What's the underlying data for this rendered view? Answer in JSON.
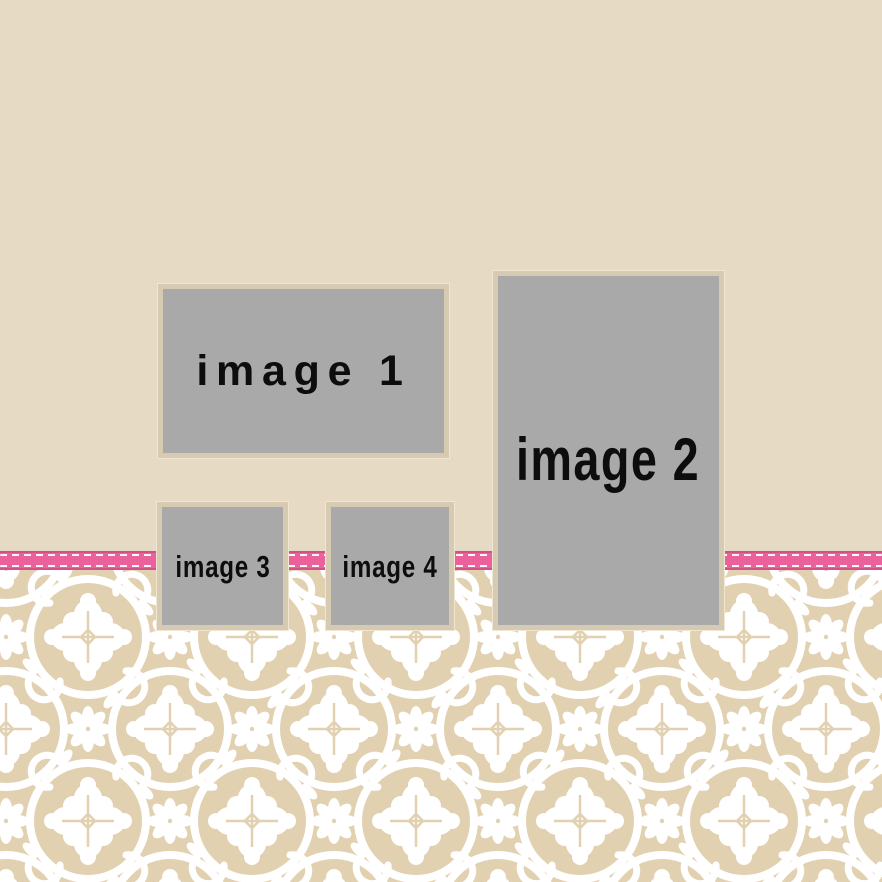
{
  "template": {
    "name": "scrapbook photo collage template",
    "placeholders": [
      {
        "id": "image-1",
        "label": "image 1"
      },
      {
        "id": "image-2",
        "label": "image 2"
      },
      {
        "id": "image-3",
        "label": "image 3"
      },
      {
        "id": "image-4",
        "label": "image 4"
      }
    ]
  },
  "decorations": {
    "ribbon": "stitched pink ribbon",
    "pattern": "white damask on tan"
  },
  "colors": {
    "background_top": "#e7dac4",
    "pattern_background": "#e2d1b1",
    "pattern_motif": "#ffffff",
    "ribbon_pink": "#ea619c",
    "ribbon_edge": "#d74e8a",
    "ribbon_stitch": "#fdf9f2",
    "placeholder_fill": "#a9a9a9",
    "placeholder_border": "#d7cab2",
    "placeholder_outline": "#f0e7d3",
    "label_color": "#0d0d0d"
  }
}
